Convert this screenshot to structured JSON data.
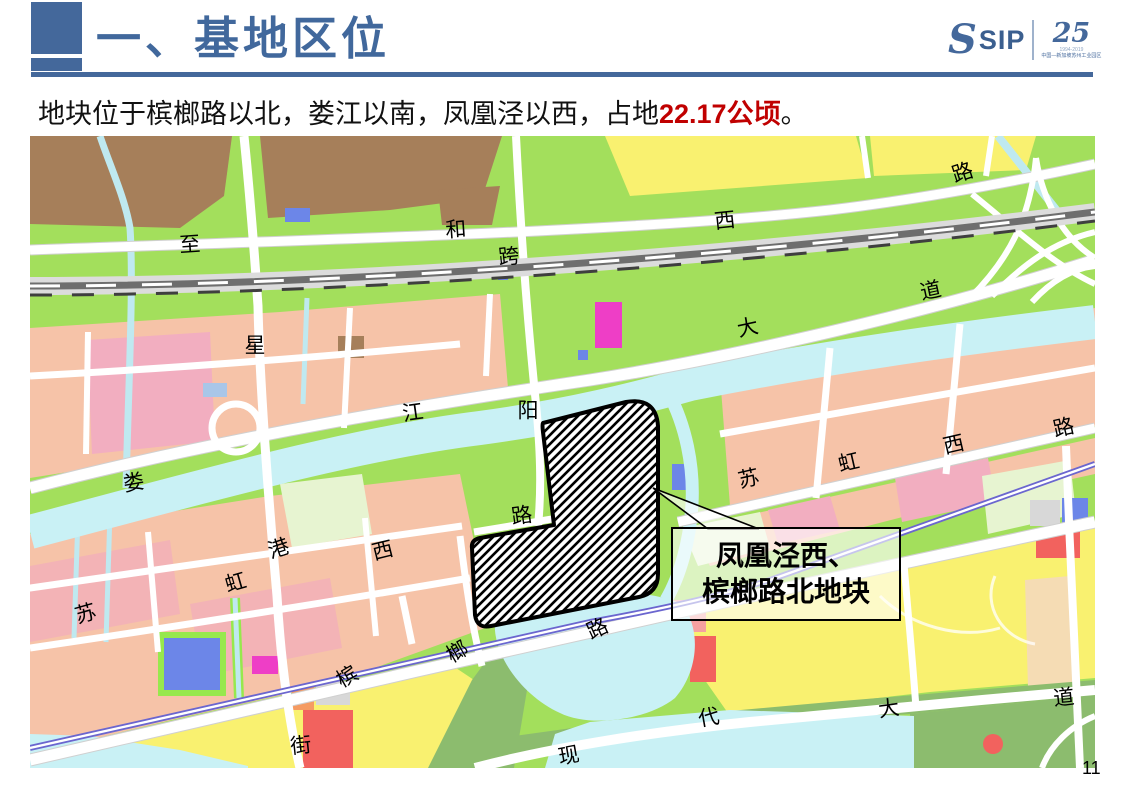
{
  "header": {
    "title": "一、基地区位",
    "logo": {
      "s_mark": "S",
      "sip": "SIP",
      "anniversary": "25",
      "years": "1994-2019",
      "org": "中国—新加坡苏州工业园区"
    }
  },
  "subtitle": {
    "prefix": "地块位于槟榔路以北，娄江以南，凤凰泾以西，占地",
    "highlight": "22.17公顷",
    "suffix": "。"
  },
  "map": {
    "callout": {
      "line1": "凤凰泾西、",
      "line2": "槟榔路北地块"
    },
    "labels": [
      {
        "text": "至",
        "x": 160,
        "y": 110,
        "rot": -4
      },
      {
        "text": "和",
        "x": 426,
        "y": 95,
        "rot": -4
      },
      {
        "text": "跨",
        "x": 479,
        "y": 122,
        "rot": -6
      },
      {
        "text": "西",
        "x": 695,
        "y": 86,
        "rot": -6
      },
      {
        "text": "路",
        "x": 933,
        "y": 38,
        "rot": -18
      },
      {
        "text": "道",
        "x": 901,
        "y": 156,
        "rot": -12
      },
      {
        "text": "大",
        "x": 718,
        "y": 193,
        "rot": -12
      },
      {
        "text": "星",
        "x": 225,
        "y": 211,
        "rot": 0
      },
      {
        "text": "江",
        "x": 383,
        "y": 278,
        "rot": -8
      },
      {
        "text": "阳",
        "x": 498,
        "y": 276,
        "rot": 0
      },
      {
        "text": "娄",
        "x": 104,
        "y": 348,
        "rot": -10
      },
      {
        "text": "路",
        "x": 492,
        "y": 381,
        "rot": -8
      },
      {
        "text": "苏",
        "x": 719,
        "y": 344,
        "rot": -13
      },
      {
        "text": "虹",
        "x": 819,
        "y": 328,
        "rot": -13
      },
      {
        "text": "西",
        "x": 924,
        "y": 310,
        "rot": -13
      },
      {
        "text": "路",
        "x": 1034,
        "y": 293,
        "rot": -13
      },
      {
        "text": "港",
        "x": 249,
        "y": 414,
        "rot": -18
      },
      {
        "text": "西",
        "x": 353,
        "y": 416,
        "rot": -14
      },
      {
        "text": "虹",
        "x": 206,
        "y": 448,
        "rot": -16
      },
      {
        "text": "苏",
        "x": 56,
        "y": 479,
        "rot": -16
      },
      {
        "text": "槟",
        "x": 318,
        "y": 542,
        "rot": -30
      },
      {
        "text": "榔",
        "x": 428,
        "y": 517,
        "rot": -30
      },
      {
        "text": "路",
        "x": 568,
        "y": 494,
        "rot": -25
      },
      {
        "text": "街",
        "x": 271,
        "y": 611,
        "rot": -6
      },
      {
        "text": "现",
        "x": 539,
        "y": 621,
        "rot": -10
      },
      {
        "text": "代",
        "x": 679,
        "y": 583,
        "rot": -10
      },
      {
        "text": "大",
        "x": 859,
        "y": 574,
        "rot": -8
      },
      {
        "text": "道",
        "x": 1034,
        "y": 563,
        "rot": -6
      }
    ]
  },
  "footer": {
    "page": "11"
  },
  "colors": {
    "accent_blue": "#44689B",
    "title_blue": "#41689C",
    "highlight_red": "#C00000",
    "map_green": "#A3DF5C",
    "water_cyan": "#C9F1F5",
    "parcel_salmon": "#F6C3A8",
    "parcel_yellow": "#F9F170",
    "parcel_brown": "#A67F5A",
    "metro_purple": "#6B66CF"
  }
}
